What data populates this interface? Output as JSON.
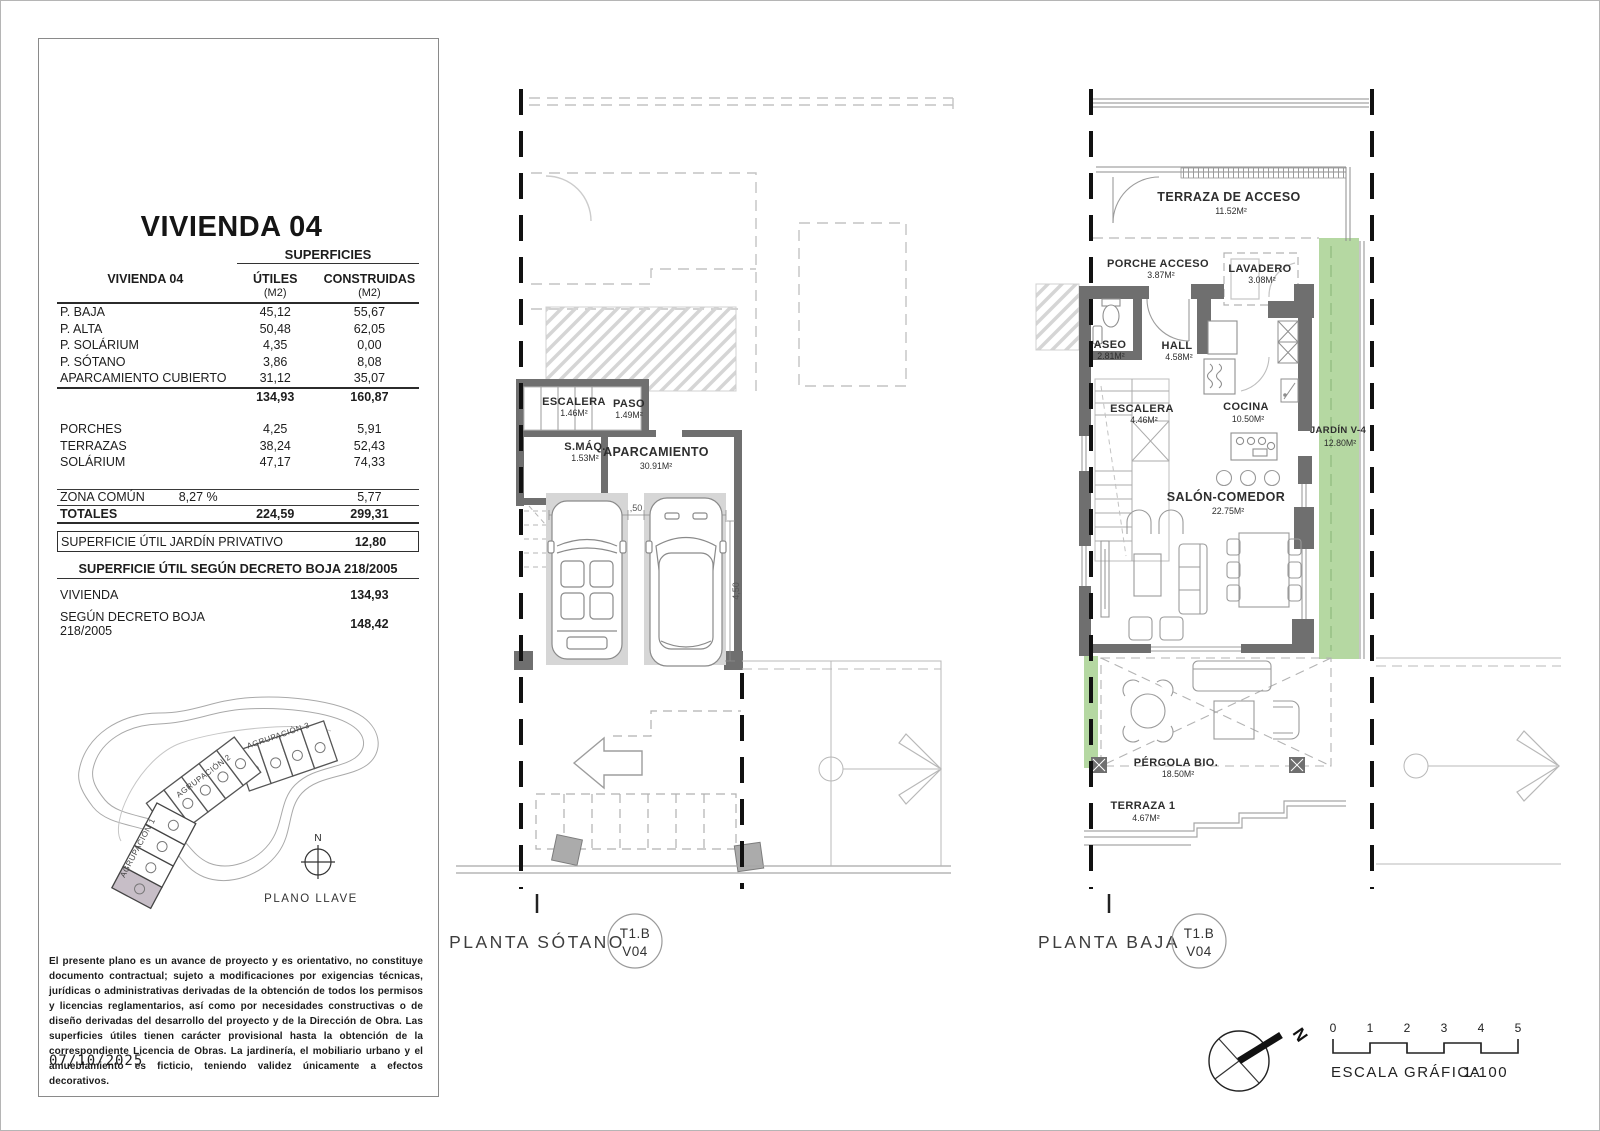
{
  "panel": {
    "title": "VIVIENDA 04",
    "table": {
      "superficies": "SUPERFICIES",
      "col_left": "VIVIENDA 04",
      "col_utiles": "ÚTILES",
      "col_construidas": "CONSTRUIDAS",
      "m2": "(M2)",
      "rows": [
        {
          "label": "P. BAJA",
          "utiles": "45,12",
          "construidas": "55,67"
        },
        {
          "label": "P. ALTA",
          "utiles": "50,48",
          "construidas": "62,05"
        },
        {
          "label": "P. SOLÁRIUM",
          "utiles": "4,35",
          "construidas": "0,00"
        },
        {
          "label": "P. SÓTANO",
          "utiles": "3,86",
          "construidas": "8,08"
        },
        {
          "label": "APARCAMIENTO CUBIERTO",
          "utiles": "31,12",
          "construidas": "35,07"
        }
      ],
      "subtotal": {
        "utiles": "134,93",
        "construidas": "160,87"
      },
      "rows2": [
        {
          "label": "PORCHES",
          "utiles": "4,25",
          "construidas": "5,91"
        },
        {
          "label": "TERRAZAS",
          "utiles": "38,24",
          "construidas": "52,43"
        },
        {
          "label": "SOLÁRIUM",
          "utiles": "47,17",
          "construidas": "74,33"
        }
      ],
      "zona_comun": {
        "label": "ZONA COMÚN",
        "pct": "8,27 %",
        "construidas": "5,77"
      },
      "totales": {
        "label": "TOTALES",
        "utiles": "224,59",
        "construidas": "299,31"
      },
      "jardin": {
        "label": "SUPERFICIE ÚTIL JARDÍN PRIVATIVO",
        "value": "12,80"
      },
      "decreto_heading": "SUPERFICIE ÚTIL SEGÚN DECRETO BOJA 218/2005",
      "decreto_rows": [
        {
          "label": "VIVIENDA",
          "value": "134,93"
        },
        {
          "label": "SEGÚN DECRETO BOJA 218/2005",
          "value": "148,42"
        }
      ]
    },
    "site": {
      "a1": "AGRUPACIÓN 1",
      "a2": "AGRUPACIÓN 2",
      "a3": "AGRUPACIÓN 3",
      "north": "N",
      "caption": "PLANO LLAVE"
    },
    "disclaimer": "El presente plano es un avance de proyecto y es orientativo, no constituye documento contractual; sujeto a modificaciones por exigencias técnicas, jurídicas o administrativas derivadas de la obtención de todos los permisos y licencias reglamentarios, así como por necesidades constructivas o de diseño derivadas del desarrollo del proyecto y de la Dirección de Obra. Las superficies útiles tienen carácter provisional hasta la obtención de la correspondiente Licencia de Obras. La jardinería, el mobiliario urbano y el amueblamiento es ficticio, teniendo validez únicamente a efectos decorativos.",
    "date": "07/10/2025"
  },
  "sotano": {
    "name": "PLANTA SÓTANO",
    "badge": {
      "l1": "T1.B",
      "l2": "V04"
    },
    "rooms": [
      {
        "name": "ESCALERA",
        "area": "1.46M²"
      },
      {
        "name": "PASO",
        "area": "1.49M²"
      },
      {
        "name": "S.MÁQ.",
        "area": "1.53M²"
      },
      {
        "name": "APARCAMIENTO",
        "area": "30.91M²"
      }
    ],
    "dims": [
      "2,20",
      ",50",
      "2,20",
      "4,50"
    ]
  },
  "baja": {
    "name": "PLANTA BAJA",
    "badge": {
      "l1": "T1.B",
      "l2": "V04"
    },
    "rooms": [
      {
        "name": "TERRAZA DE ACCESO",
        "area": "11.52M²"
      },
      {
        "name": "PORCHE ACCESO",
        "area": "3.87M²"
      },
      {
        "name": "LAVADERO",
        "area": "3.08M²"
      },
      {
        "name": "ASEO",
        "area": "2.81M²"
      },
      {
        "name": "HALL",
        "area": "4.58M²"
      },
      {
        "name": "ESCALERA",
        "area": "4.46M²"
      },
      {
        "name": "COCINA",
        "area": "10.50M²"
      },
      {
        "name": "JARDÍN V-4",
        "area": "12.80M²"
      },
      {
        "name": "SALÓN-COMEDOR",
        "area": "22.75M²"
      },
      {
        "name": "PÉRGOLA BIO.",
        "area": "18.50M²"
      },
      {
        "name": "TERRAZA 1",
        "area": "4.67M²"
      }
    ]
  },
  "scalebar": {
    "caption": "ESCALA GRÁFICA",
    "ratio": "1:100",
    "north": "N",
    "ticks": [
      "0",
      "1",
      "2",
      "3",
      "4",
      "5"
    ]
  },
  "colors": {
    "garden": "#b5d8a2",
    "wall": "#6f6f6f",
    "highlight": "#c7bec7"
  }
}
